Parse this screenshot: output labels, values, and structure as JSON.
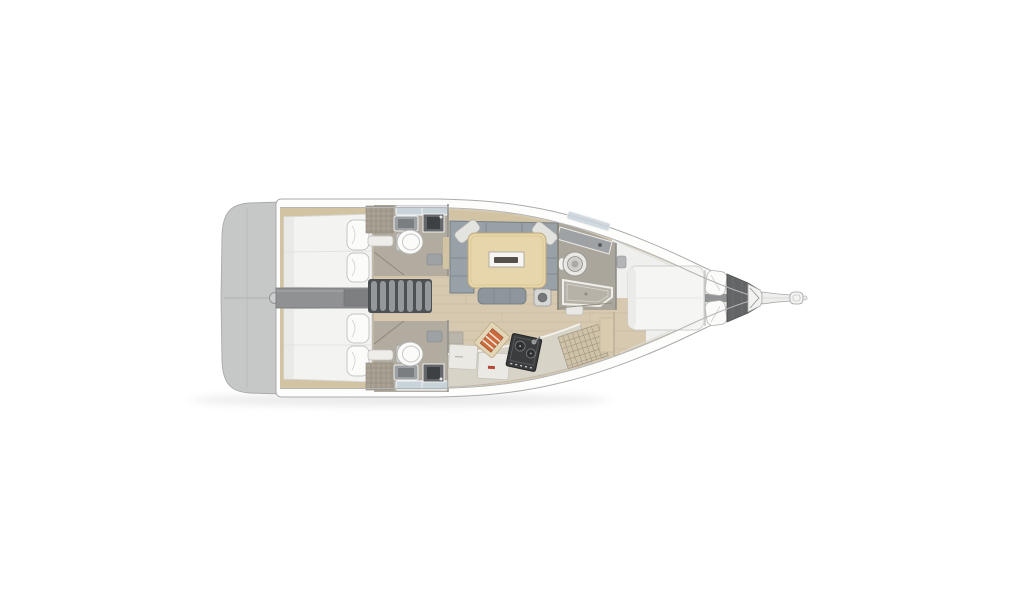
{
  "page": {
    "background": "#ffffff",
    "description": "Top-view interior layout plan of a sailing yacht, bow pointing right, stern (swim platform) at left. No text labels are rendered in the image."
  },
  "colors": {
    "page_bg": "#ffffff",
    "hull_white": "#fdfdfc",
    "hull_outline": "#aaabac",
    "swim_platform": "#c6c7c7",
    "floor_wood": "#d7c9b0",
    "plank_line": "#c6b79d",
    "accent_beige": "#d2c4a3",
    "bed_white": "#f3f3f1",
    "pillow_white": "#fbfbfa",
    "sofa_gray": "#99a1a8",
    "cushion_light": "#e3e3df",
    "table_wood": "#e7d6ab",
    "counter_beige": "#d7d3c7",
    "head_floor": "#b1aba0",
    "engine_gray": "#8f9193",
    "stairs_dark": "#4d5053",
    "stairs_rib": "#94989c",
    "stove_dark": "#3a3c3e",
    "anchor_locker": "#636567",
    "skylight_blue": "#c9d3da",
    "fwd_platform": "#efefed",
    "board_wood": "#e3d5b8",
    "item_orange": "#cc6c3e",
    "shadow": "#c2c2c2"
  },
  "boat": {
    "orientation": {
      "bow": "right",
      "stern": "left"
    },
    "areas": [
      {
        "name": "swim-platform",
        "label": "Stern swim platform"
      },
      {
        "name": "aft-cabin-port",
        "label": "Port aft double cabin"
      },
      {
        "name": "aft-cabin-starboard",
        "label": "Starboard aft double cabin"
      },
      {
        "name": "aft-head-port",
        "label": "Port aft head with toilet and sink"
      },
      {
        "name": "aft-head-starboard",
        "label": "Starboard aft head with toilet and sink"
      },
      {
        "name": "companionway-stairs",
        "label": "Companionway steps"
      },
      {
        "name": "saloon",
        "label": "Saloon with U-shaped sofa and table"
      },
      {
        "name": "galley",
        "label": "Galley with stove, worktop and lockers"
      },
      {
        "name": "forward-head",
        "label": "Forward head with round basin and shower"
      },
      {
        "name": "forward-cabin",
        "label": "Forward cabin with island berth"
      },
      {
        "name": "anchor-locker",
        "label": "Anchor locker"
      },
      {
        "name": "bowsprit",
        "label": "Bowsprit"
      }
    ]
  }
}
